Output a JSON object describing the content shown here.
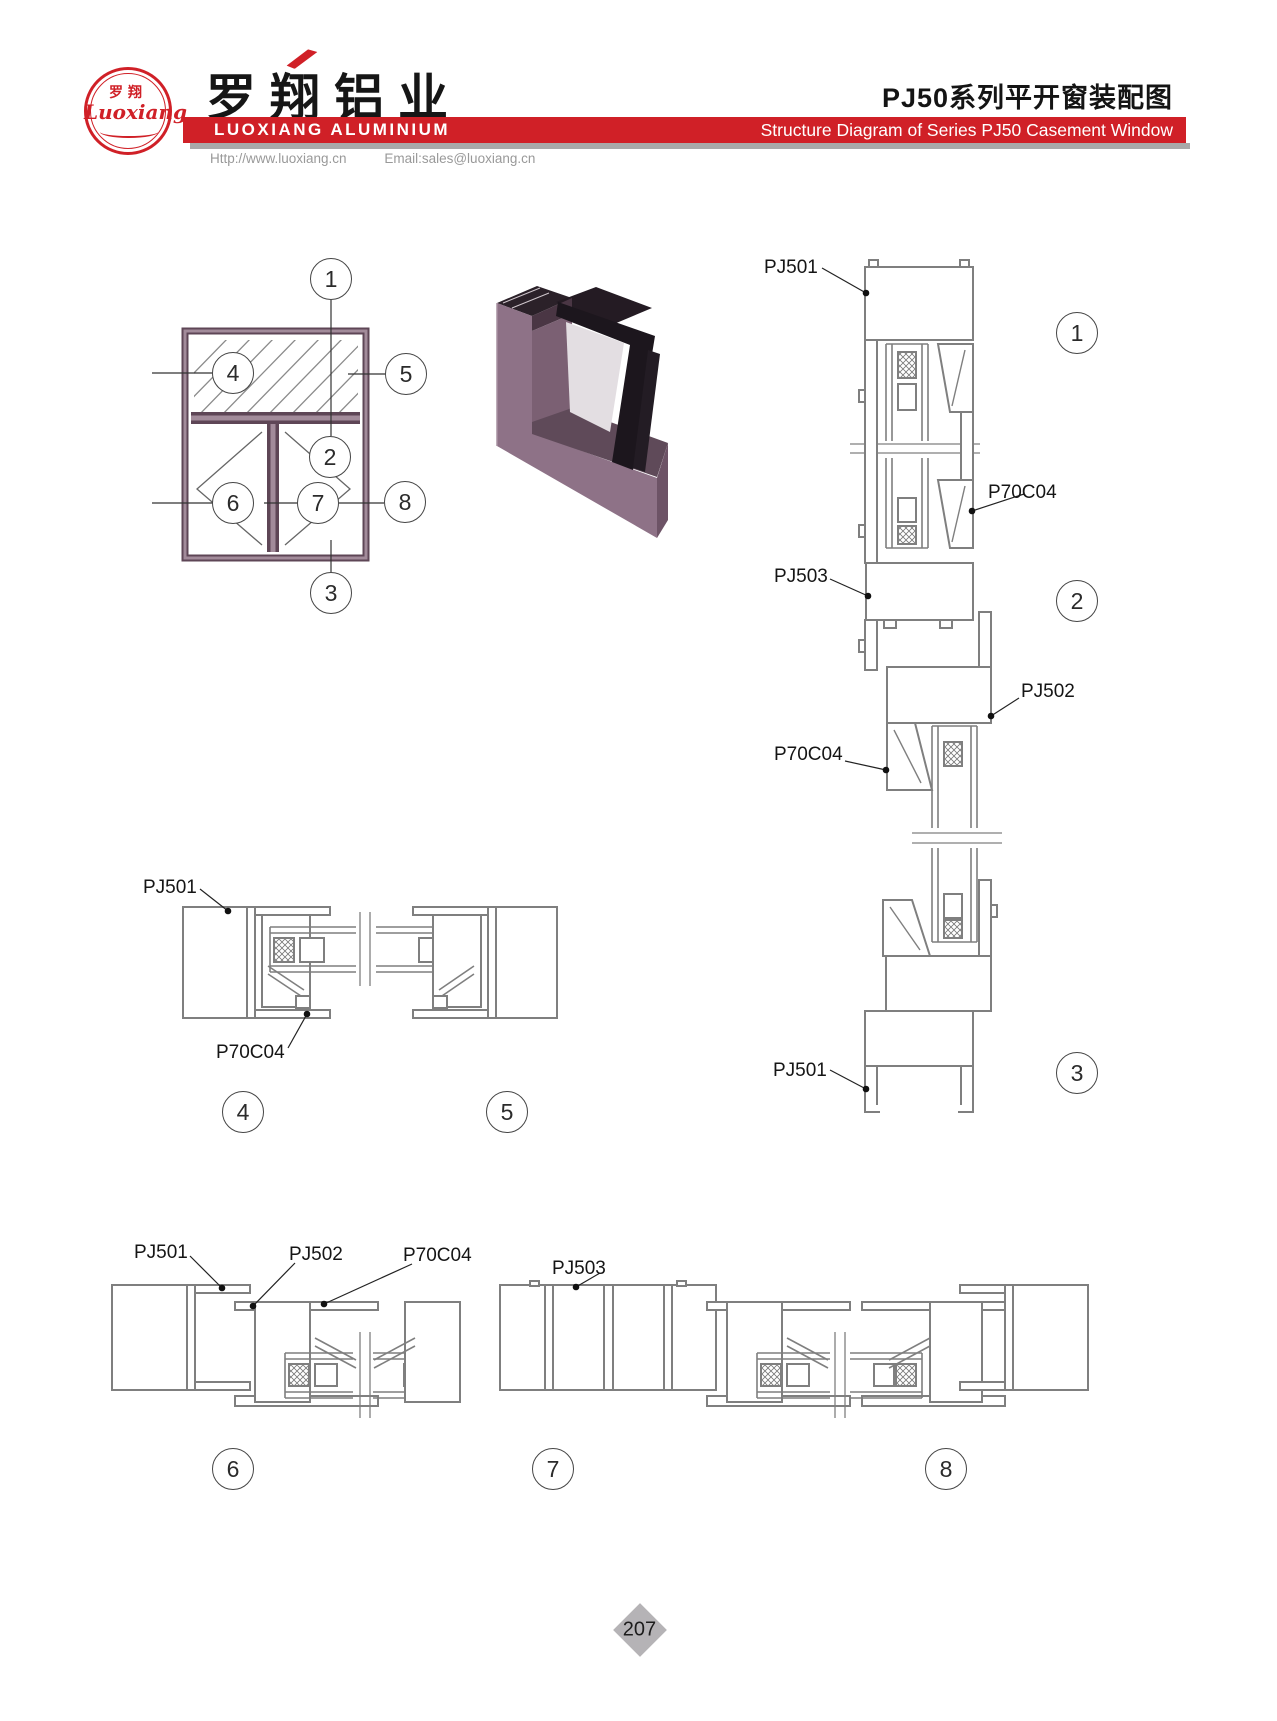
{
  "header": {
    "logo_cn": "罗翔",
    "logo_script": "Luoxiang",
    "company_cn": "罗翔铝业",
    "company_en": "LUOXIANG ALUMINIUM",
    "website": "Http://www.luoxiang.cn",
    "email": "Email:sales@luoxiang.cn",
    "title_cn": "PJ50系列平开窗装配图",
    "title_en": "Structure Diagram of Series PJ50 Casement Window"
  },
  "colors": {
    "brand_red": "#d02027",
    "frame_purple_dark": "#5e4656",
    "frame_purple_light": "#a28b9a",
    "drawing_gray": "#7f7f7f",
    "page_marker_gray": "#b5b3b6"
  },
  "callouts": {
    "n1": "1",
    "n2": "2",
    "n3": "3",
    "n4": "4",
    "n5": "5",
    "n6": "6",
    "n7": "7",
    "n8": "8"
  },
  "labels": {
    "pj501": "PJ501",
    "pj502": "PJ502",
    "pj503": "PJ503",
    "p70c04": "P70C04"
  },
  "page": {
    "number": "207"
  }
}
